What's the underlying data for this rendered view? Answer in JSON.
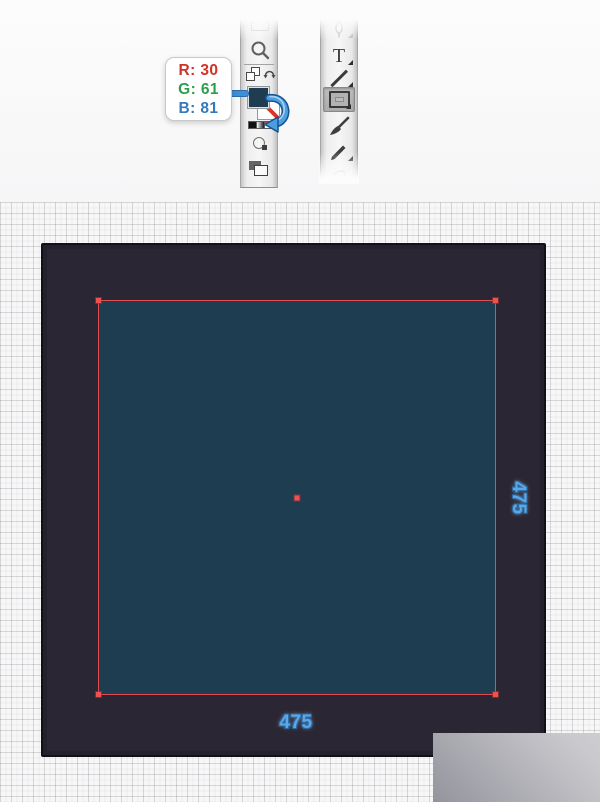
{
  "colors": {
    "fill_color": "#1e3d51",
    "artboard_fill": "#2b2634",
    "selection_red": "#e04c50",
    "dimension_label_blue": "#5ea7e4",
    "accent_blue": "#3d8fd8",
    "tooltip_r_red": "#cf3227",
    "tooltip_g_green": "#2d9e49",
    "tooltip_b_blue": "#3579bb"
  },
  "tooltip": {
    "r_value": "R: 30",
    "g_value": "G: 61",
    "b_value": "B: 81"
  },
  "toolbars": {
    "left": {
      "icons": [
        "hand-tool",
        "zoom-tool",
        "default-fill-stroke",
        "swap-fill-stroke",
        "fill-swatch",
        "stroke-none-swatch",
        "color-chip",
        "gradient-chip",
        "none-chip",
        "draw-mode",
        "screen-mode"
      ]
    },
    "right": {
      "type_tool_glyph": "T",
      "selected_tool": "rectangle-tool",
      "icons": [
        "pen-tool",
        "type-tool",
        "line-segment-tool",
        "rectangle-tool",
        "paintbrush-tool",
        "pencil-tool",
        "shaper-tool"
      ]
    }
  },
  "canvas": {
    "rect_width_label": "475",
    "rect_height_label": "475"
  }
}
